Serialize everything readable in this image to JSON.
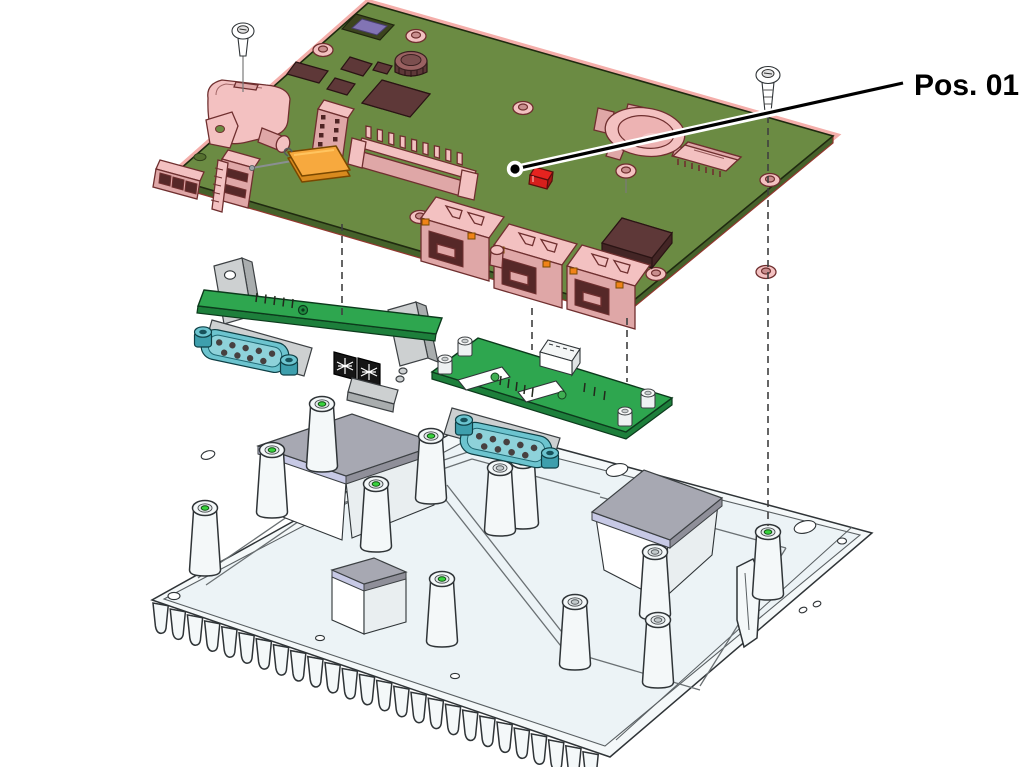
{
  "diagram": {
    "callout": {
      "label": "Pos. 01"
    }
  },
  "colors": {
    "board_green": "#6B8B43",
    "board_edge": "#45612A",
    "edge_glow": "#F2A09B",
    "pcb_bright_green": "#2EA64F",
    "pink_light": "#F3C1C1",
    "pink_mid": "#DFA7A7",
    "pink_dark": "#C98E8E",
    "pink_outline": "#6F2F2F",
    "alert_red": "#E6231F",
    "accent_orange": "#F7A93E",
    "orange_led": "#F08318",
    "db9_teal": "#6CC4CF",
    "chip_maroon": "#5E3838",
    "recess_purple": "#8274B4",
    "chassis_white": "#F4F8F9",
    "pad_gray": "#A7A8B2",
    "pad_lavender": "#C7C9E5",
    "line_dark": "#2F3437",
    "screwhole_green": "#38D23D"
  }
}
